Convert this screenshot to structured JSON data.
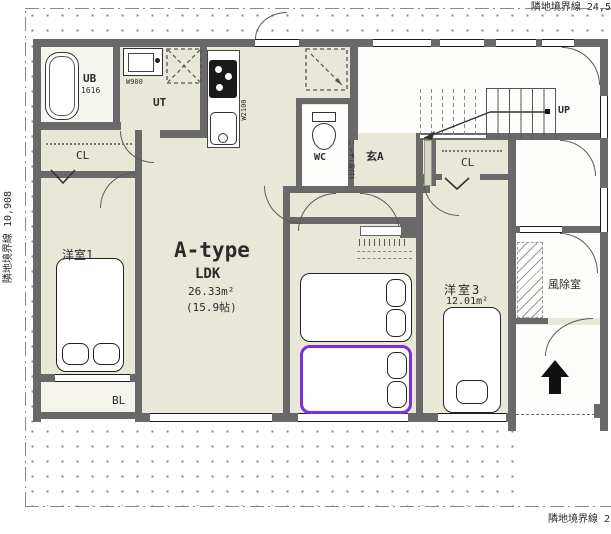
{
  "boundaries": {
    "top": "隣地境界線  24,5",
    "left": "隣地境界線  10,908",
    "bottom": "隣地境界線  2"
  },
  "unit": {
    "type": "A-type",
    "ldk": "LDK",
    "area": "26.33m²",
    "tatami": "(15.9帖)"
  },
  "rooms": {
    "bath": {
      "label": "UB",
      "size": "1616"
    },
    "utility": {
      "label": "UT"
    },
    "vanity": {
      "width": "W900"
    },
    "kitchen": {
      "width": "W2100"
    },
    "toilet": {
      "label": "WC"
    },
    "entrance": {
      "label": "玄A"
    },
    "niche": {
      "label": "ニッチ(扉付)"
    },
    "closet1": {
      "label": "CL"
    },
    "closet3": {
      "label": "CL"
    },
    "bedroom1": {
      "label": "洋室1"
    },
    "bedroom3": {
      "label": "洋室3",
      "area": "12.01m²"
    },
    "windbreak": {
      "label": "風除室"
    },
    "balcony": {
      "label": "BL"
    },
    "stairs": {
      "label": "UP"
    }
  },
  "colors": {
    "wall": "#696969",
    "room_fill": "#e9e8d8",
    "highlight": "#7b2fe0"
  }
}
